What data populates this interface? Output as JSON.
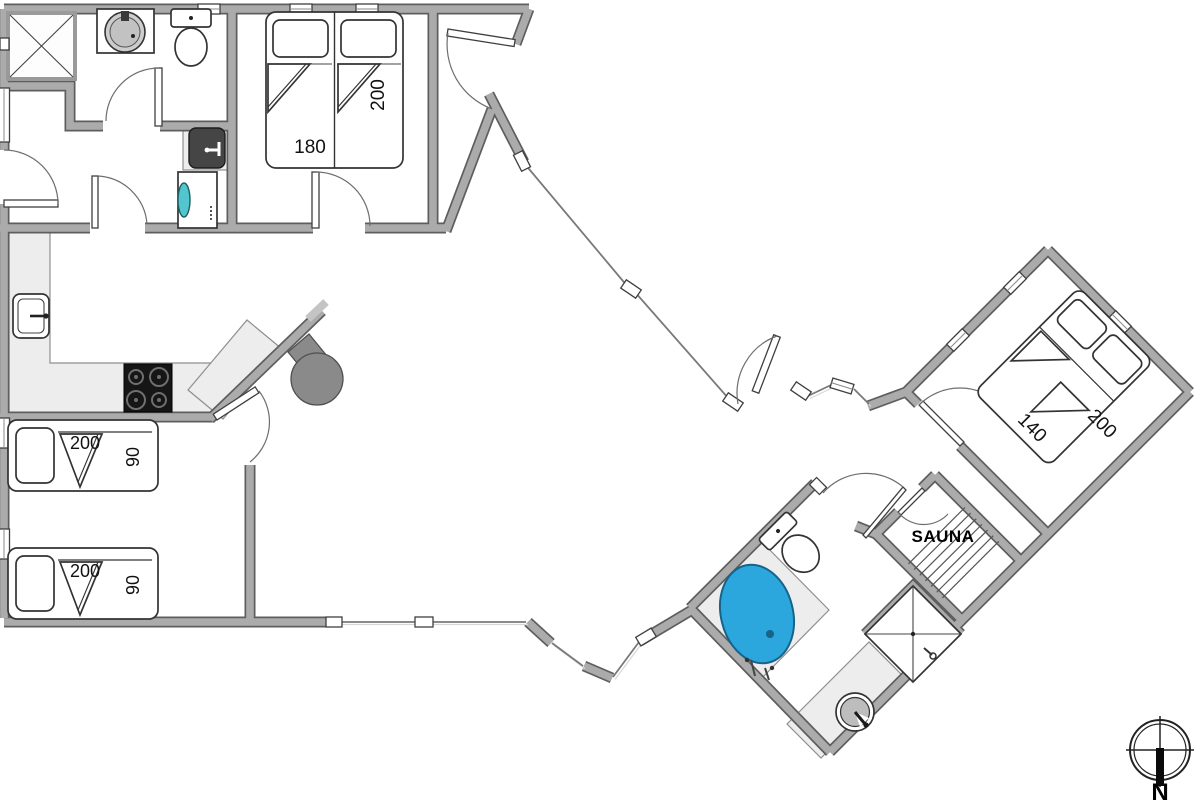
{
  "labels": {
    "bedroom_top": {
      "bed_width": "180",
      "bed_length": "200"
    },
    "bunk_top": {
      "bed_length": "200",
      "bed_width": "90"
    },
    "bunk_bottom": {
      "bed_length": "200",
      "bed_width": "90"
    },
    "bedroom_right": {
      "bed_width": "140",
      "bed_length": "200"
    },
    "sauna": "SAUNA",
    "compass_north": "N"
  },
  "colors": {
    "wall-fill": "#ababab",
    "wall-edge": "#5e5e5e",
    "counter": "#ededed",
    "counter-edge": "#8f8f8f",
    "glass": "#7a7a7a",
    "tub-blue": "#2ba7dd",
    "tub-edge": "#17638a",
    "washer-teal": "#52c6cf",
    "stove-black": "#161616",
    "fireplace-gray": "#8a8a8a"
  },
  "fixtures": [
    "shower-cabin",
    "washbasin-round",
    "toilet",
    "utility-sink",
    "washing-machine",
    "double-bed-180x200",
    "kitchen-sink",
    "stove-hob",
    "kitchen-island",
    "fireplace",
    "single-bed-200x90",
    "single-bed-200x90",
    "double-bed-140x200",
    "sauna-benches",
    "whirlpool-tub",
    "corner-shower",
    "washbasin-round",
    "compass-rose"
  ]
}
